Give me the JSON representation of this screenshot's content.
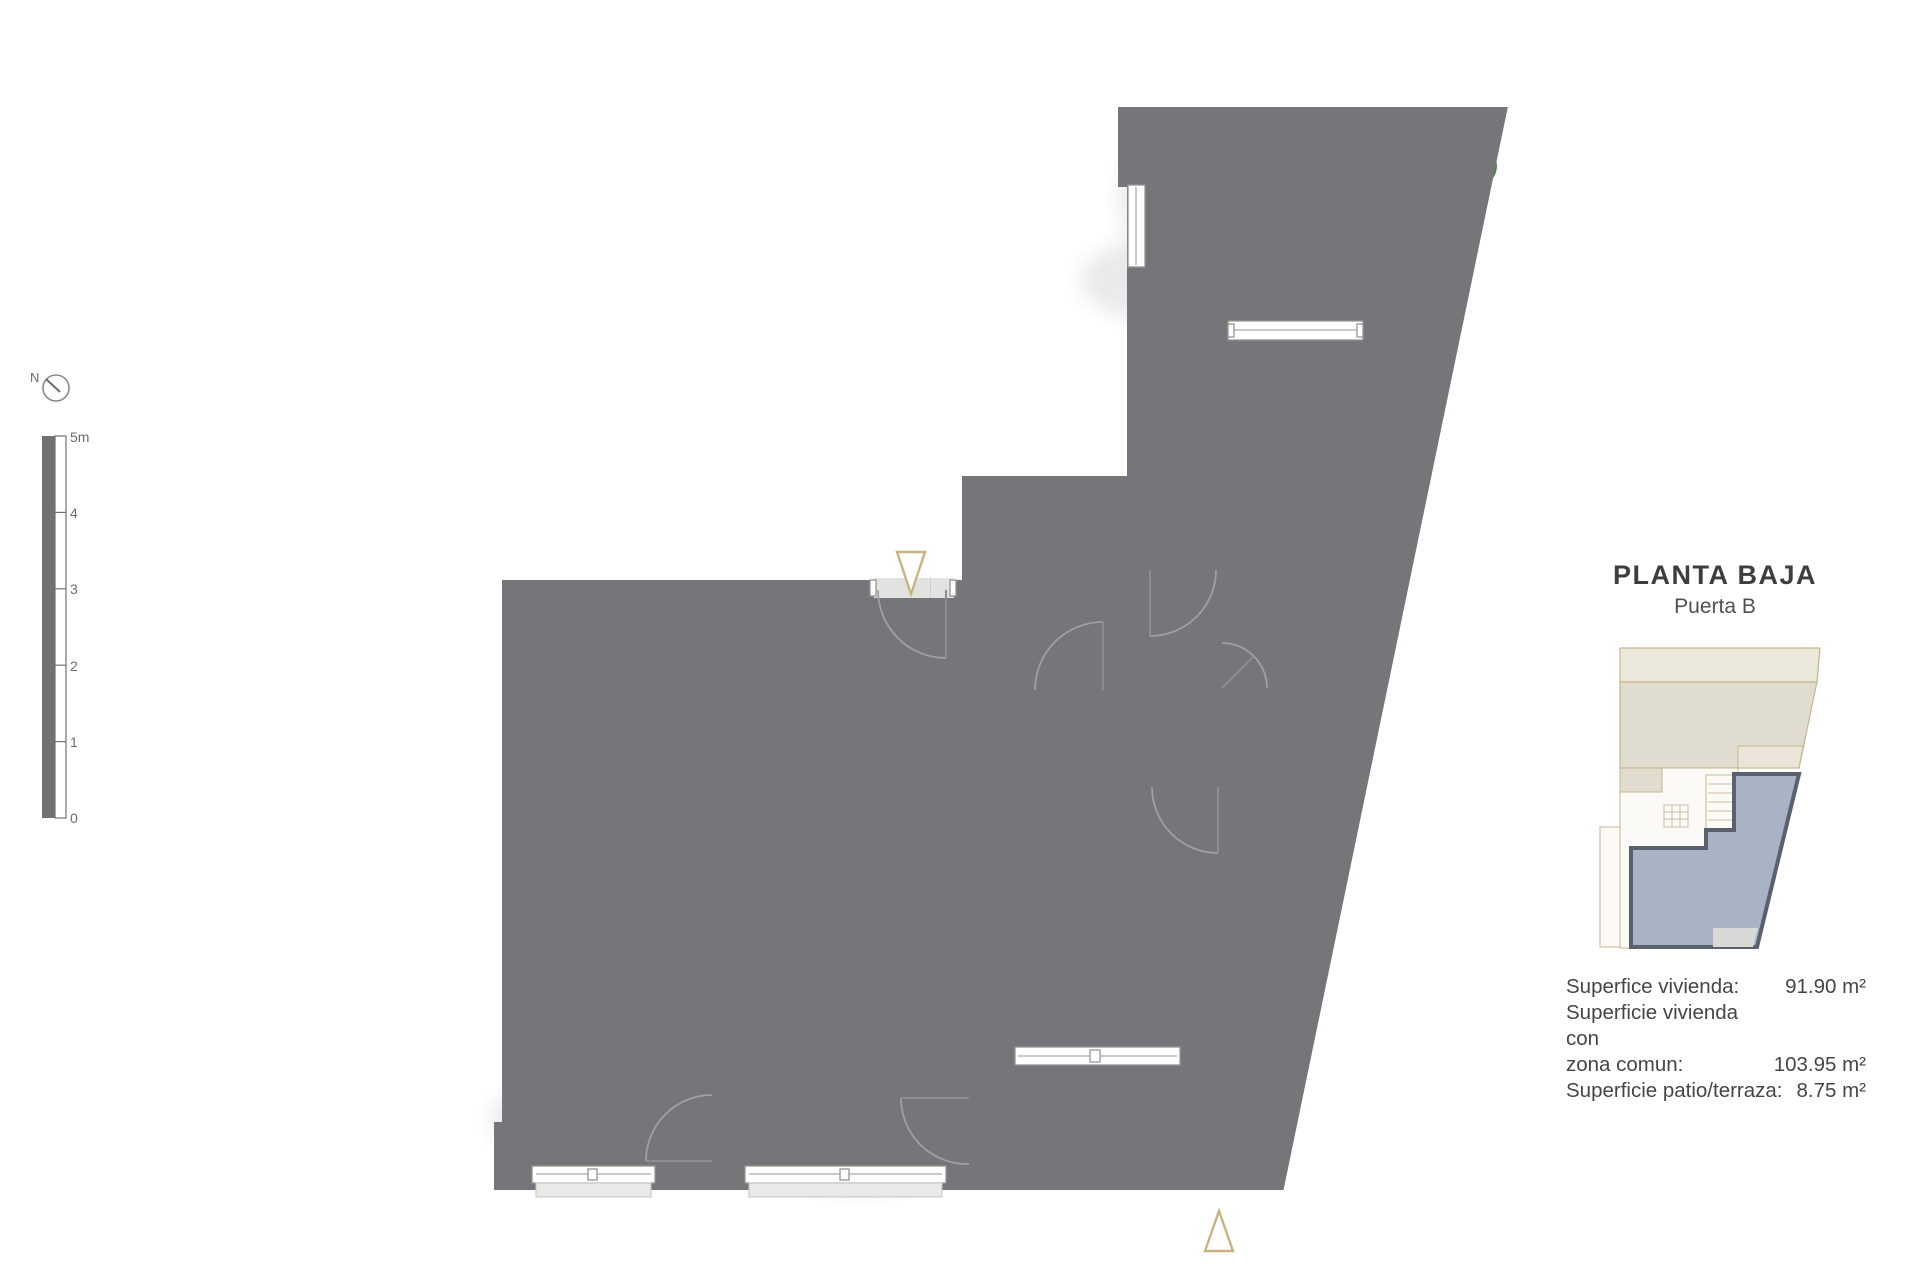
{
  "title_block": {
    "title": "PLANTA BAJA",
    "subtitle": "Puerta B"
  },
  "surface_table": {
    "rows": [
      {
        "line1": "Superfice vivienda:",
        "line2": "",
        "value": "91.90 m²"
      },
      {
        "line1": "Superficie vivienda con",
        "line2": "zona comun:",
        "value": "103.95 m²"
      },
      {
        "line1": "Superficie patio/terraza:",
        "line2": "",
        "value": "8.75 m²"
      }
    ]
  },
  "compass": {
    "label": "N",
    "icon": "north-compass-icon"
  },
  "scale_bar": {
    "ticks": [
      "5m",
      "4",
      "3",
      "2",
      "1",
      "0"
    ]
  },
  "markers": {
    "entrance": "triangle-down-icon",
    "section": "triangle-up-icon"
  },
  "colors": {
    "wall": "#74767a",
    "interior_floor": "#e2e2e0",
    "terrace_floor": "#aeaeac",
    "wood": "#c4a876",
    "marker_outline": "#c9b480",
    "locator_unit_fill": "#a9b3c6",
    "locator_unit_outline": "#59616f",
    "locator_building_outline": "#c8b48e",
    "plant_green": "#55823f"
  }
}
